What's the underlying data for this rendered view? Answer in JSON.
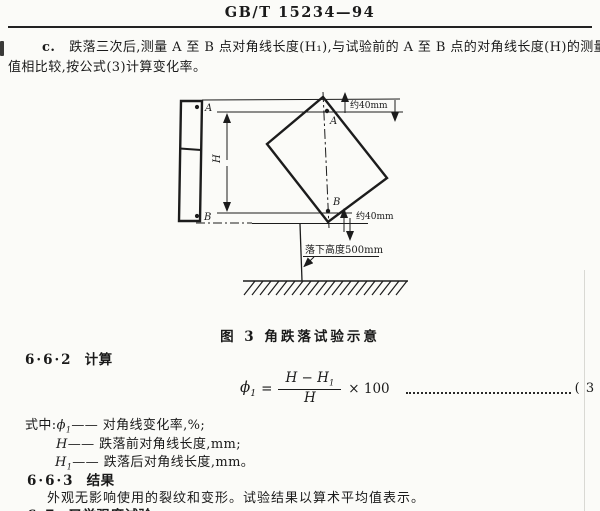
{
  "header": {
    "standard_number": "GB/T 15234—94"
  },
  "paragraph_c": {
    "label": "c.",
    "line1": "跌落三次后,测量 A 至 B 点对角线长度(H₁),与试验前的 A 至 B 点的对角线长度(H)的测量",
    "line2": "值相比较,按公式(3)计算变化率。"
  },
  "figure": {
    "caption": "图 3  角跌落试验示意",
    "labels": {
      "point_a": "A",
      "point_b": "B",
      "spec_a": "A",
      "spec_b": "B",
      "diag_h": "H",
      "dim_top": "约40mm",
      "dim_bottom": "约40mm",
      "drop_height": "落下高度500mm"
    }
  },
  "calc_section": {
    "number": "6·6·2",
    "title": "计算"
  },
  "formula": {
    "phi": "ϕ",
    "phi_sub": "1",
    "equals": "=",
    "num_left": "H",
    "num_minus": " − ",
    "num_right": "H",
    "num_right_sub": "1",
    "den": "H",
    "multiplier": "× 100",
    "eq_no": "( 3 )"
  },
  "where": {
    "intro": "式中:",
    "items": [
      {
        "sym": "ϕ",
        "sub": "1",
        "desc": "—— 对角线变化率,%;"
      },
      {
        "sym": "H",
        "sub": "",
        "desc": "—— 跌落前对角线长度,mm;"
      },
      {
        "sym": "H",
        "sub": "1",
        "desc": "—— 跌落后对角线长度,mm。"
      }
    ]
  },
  "result_section": {
    "number": "6·6·3",
    "title": "结果",
    "body": "外观无影响使用的裂纹和变形。试验结果以算术平均值表示。"
  },
  "next_section": {
    "number": "6·7",
    "title": "叉举强度试验"
  }
}
